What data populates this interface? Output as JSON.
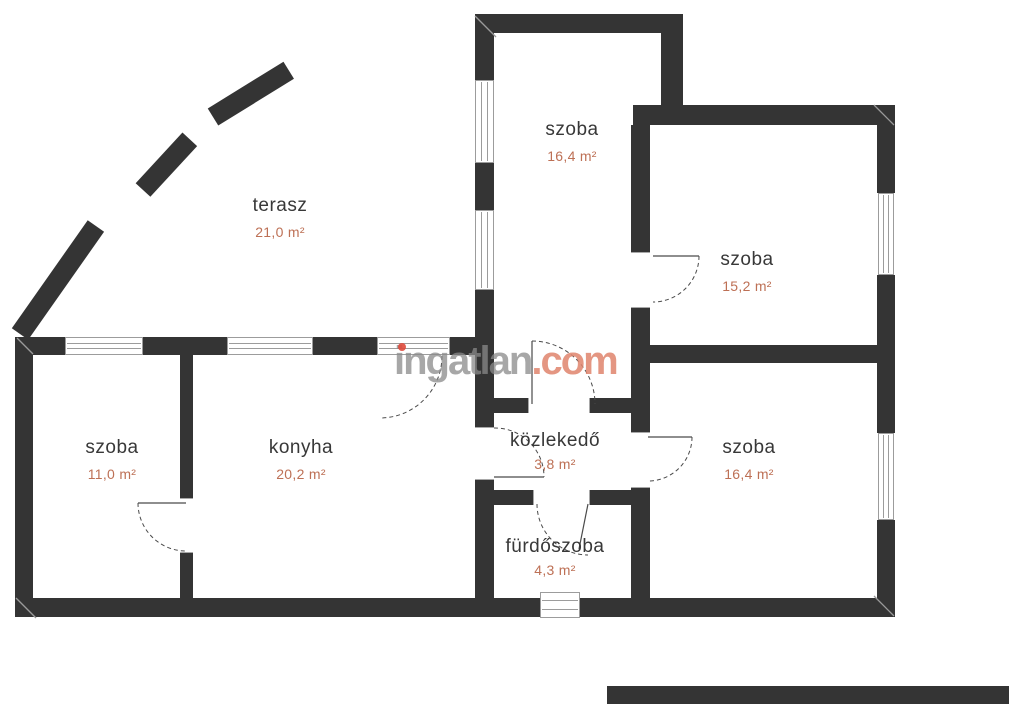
{
  "watermark": {
    "brand": "ingatlan",
    "tld": ".com"
  },
  "rooms": [
    {
      "id": "terasz",
      "name": "terasz",
      "area": "21,0 m²"
    },
    {
      "id": "szoba-top",
      "name": "szoba",
      "area": "16,4 m²"
    },
    {
      "id": "szoba-right",
      "name": "szoba",
      "area": "15,2 m²"
    },
    {
      "id": "szoba-left",
      "name": "szoba",
      "area": "11,0 m²"
    },
    {
      "id": "konyha",
      "name": "konyha",
      "area": "20,2 m²"
    },
    {
      "id": "kozlekedo",
      "name": "közlekedő",
      "area": "3,8 m²"
    },
    {
      "id": "szoba-bottom",
      "name": "szoba",
      "area": "16,4 m²"
    },
    {
      "id": "furdoszoba",
      "name": "fürdőszoba",
      "area": "4,3 m²"
    }
  ],
  "colors": {
    "wall": "#343434",
    "room_text": "#383838",
    "area_text": "#bd7055",
    "watermark_gray": "#8a8a8a",
    "watermark_salmon": "#df846c",
    "watermark_dot": "#df4a3c"
  }
}
